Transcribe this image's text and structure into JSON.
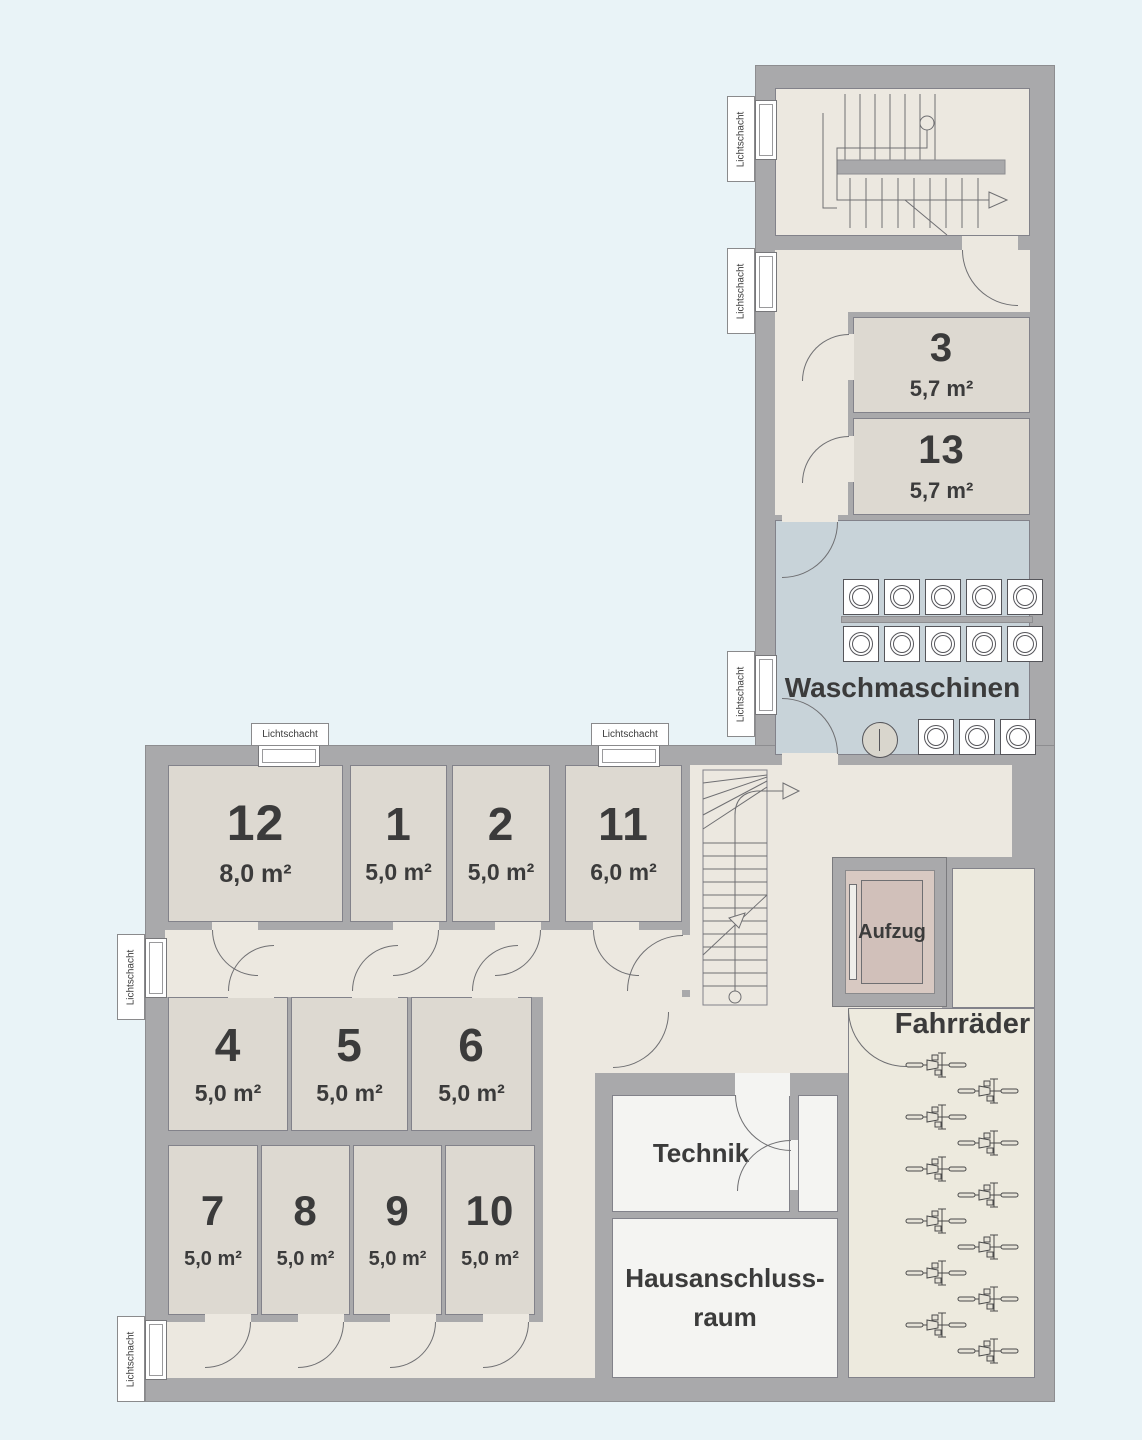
{
  "labels": {
    "waschmaschinen": "Waschmaschinen",
    "fahrraeder": "Fahrräder",
    "technik": "Technik",
    "hausanschluss_line1": "Hausanschluss-",
    "hausanschluss_line2": "raum",
    "aufzug": "Aufzug",
    "lichtschacht": "Lichtschacht"
  },
  "rooms": [
    {
      "id": "12",
      "area": "8,0 m²"
    },
    {
      "id": "1",
      "area": "5,0 m²"
    },
    {
      "id": "2",
      "area": "5,0 m²"
    },
    {
      "id": "11",
      "area": "6,0 m²"
    },
    {
      "id": "4",
      "area": "5,0 m²"
    },
    {
      "id": "5",
      "area": "5,0 m²"
    },
    {
      "id": "6",
      "area": "5,0 m²"
    },
    {
      "id": "7",
      "area": "5,0 m²"
    },
    {
      "id": "8",
      "area": "5,0 m²"
    },
    {
      "id": "9",
      "area": "5,0 m²"
    },
    {
      "id": "10",
      "area": "5,0 m²"
    },
    {
      "id": "3",
      "area": "5,7 m²"
    },
    {
      "id": "13",
      "area": "5,7 m²"
    }
  ],
  "equipment": {
    "washing_machines_row1": 5,
    "washing_machines_row2": 5,
    "washing_machines_row3": 3,
    "bicycles": 12,
    "light_shaft_count": 7
  },
  "colors": {
    "background": "#e9f3f7",
    "wall": "#a9a9ab",
    "corridor_floor": "#ece8e0",
    "storage_room_floor": "#ddd9d1",
    "laundry_floor": "#c8d3d9",
    "utility_floor": "#f4f4f2",
    "elevator_interior": "#d8c9c2",
    "text": "#3b3b3b"
  }
}
